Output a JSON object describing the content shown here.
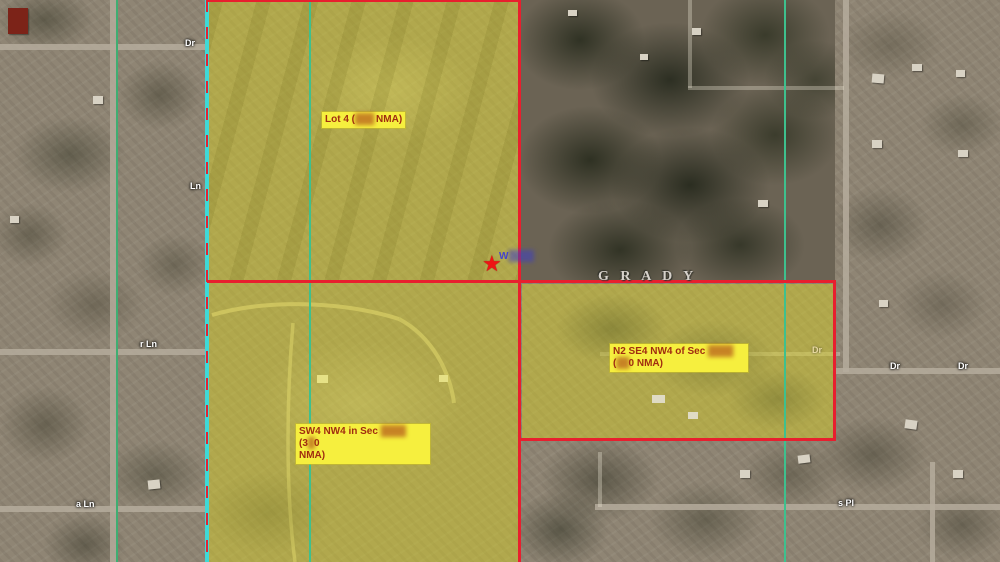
{
  "map": {
    "county_label": "G R A D Y",
    "star_glyph": "★",
    "annotation": {
      "prefix": "W",
      "redacted": "████"
    },
    "colors": {
      "parcel_boundary_red": "#e81f2e",
      "survey_green": "#3fae72",
      "survey_teal": "#3ec08e",
      "boundary_cyan": "#3fd9d6",
      "parcel_fill_yellow": "#e0d818",
      "label_bg": "#f6ef3e",
      "label_text": "#a02c10"
    }
  },
  "parcels": [
    {
      "id": "lot4",
      "lines": [
        [
          {
            "text": "Lot 4 ("
          },
          {
            "text": "███",
            "redacted": true
          },
          {
            "text": " NMA)"
          }
        ]
      ]
    },
    {
      "id": "sw4-nw4",
      "lines": [
        [
          {
            "text": "SW4 NW4 in Sec "
          },
          {
            "text": "████",
            "redacted": true
          },
          {
            "text": " (3"
          },
          {
            "text": "█",
            "redacted": true
          },
          {
            "text": "0"
          }
        ],
        [
          {
            "text": "NMA)"
          }
        ]
      ]
    },
    {
      "id": "n2-se4-nw4",
      "lines": [
        [
          {
            "text": "N2 SE4 NW4 of Sec "
          },
          {
            "text": "████",
            "redacted": true
          }
        ],
        [
          {
            "text": "("
          },
          {
            "text": "██",
            "redacted": true
          },
          {
            "text": "0 NMA)"
          }
        ]
      ]
    }
  ],
  "road_labels": [
    {
      "text": "Dr"
    },
    {
      "text": "Ln"
    },
    {
      "text": "r Ln"
    },
    {
      "text": "a Ln"
    },
    {
      "text": "Dr"
    },
    {
      "text": "Dr"
    },
    {
      "text": "Dr"
    },
    {
      "text": "s Pl"
    }
  ]
}
